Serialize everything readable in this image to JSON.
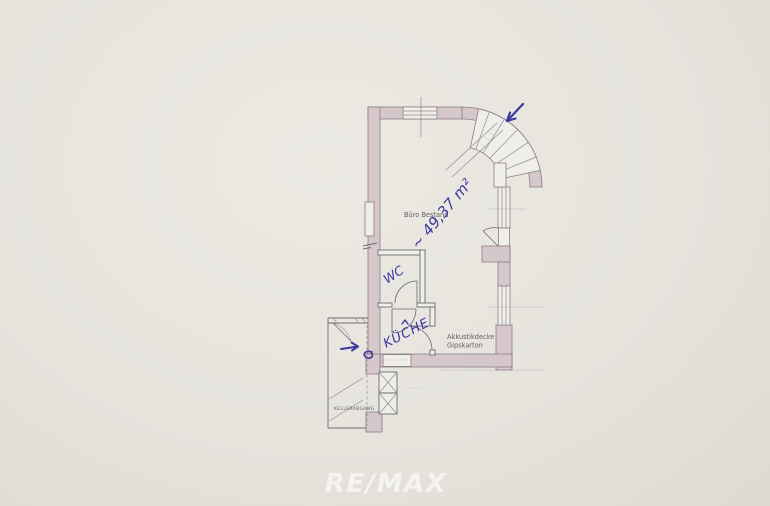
{
  "plan": {
    "room_label": "Büro Bestand",
    "ceiling_note": {
      "line1": "Akkustikdecke",
      "line2": "Gipskarton"
    },
    "basement_label": "KELLERABGANG",
    "handwritten": {
      "area": "~ 49,37 m²",
      "wc": "WC",
      "kitchen": "KÜCHE",
      "ink_color": "#3d37a0"
    },
    "colors": {
      "paper": "#e6e4dd",
      "paper_highlight": "#ebe9e2",
      "paper_shadow": "#dcdad2",
      "wall_fill": "#d6c8ca",
      "wall_stroke": "#8a7e87",
      "window_fill": "#f0eee8",
      "thin_line": "#8e8e96",
      "partition_stroke": "#6c6c74",
      "printed_text": "#5e5e66"
    }
  },
  "watermark": {
    "text": "RE/MAX",
    "color": "#f8f7f3"
  }
}
